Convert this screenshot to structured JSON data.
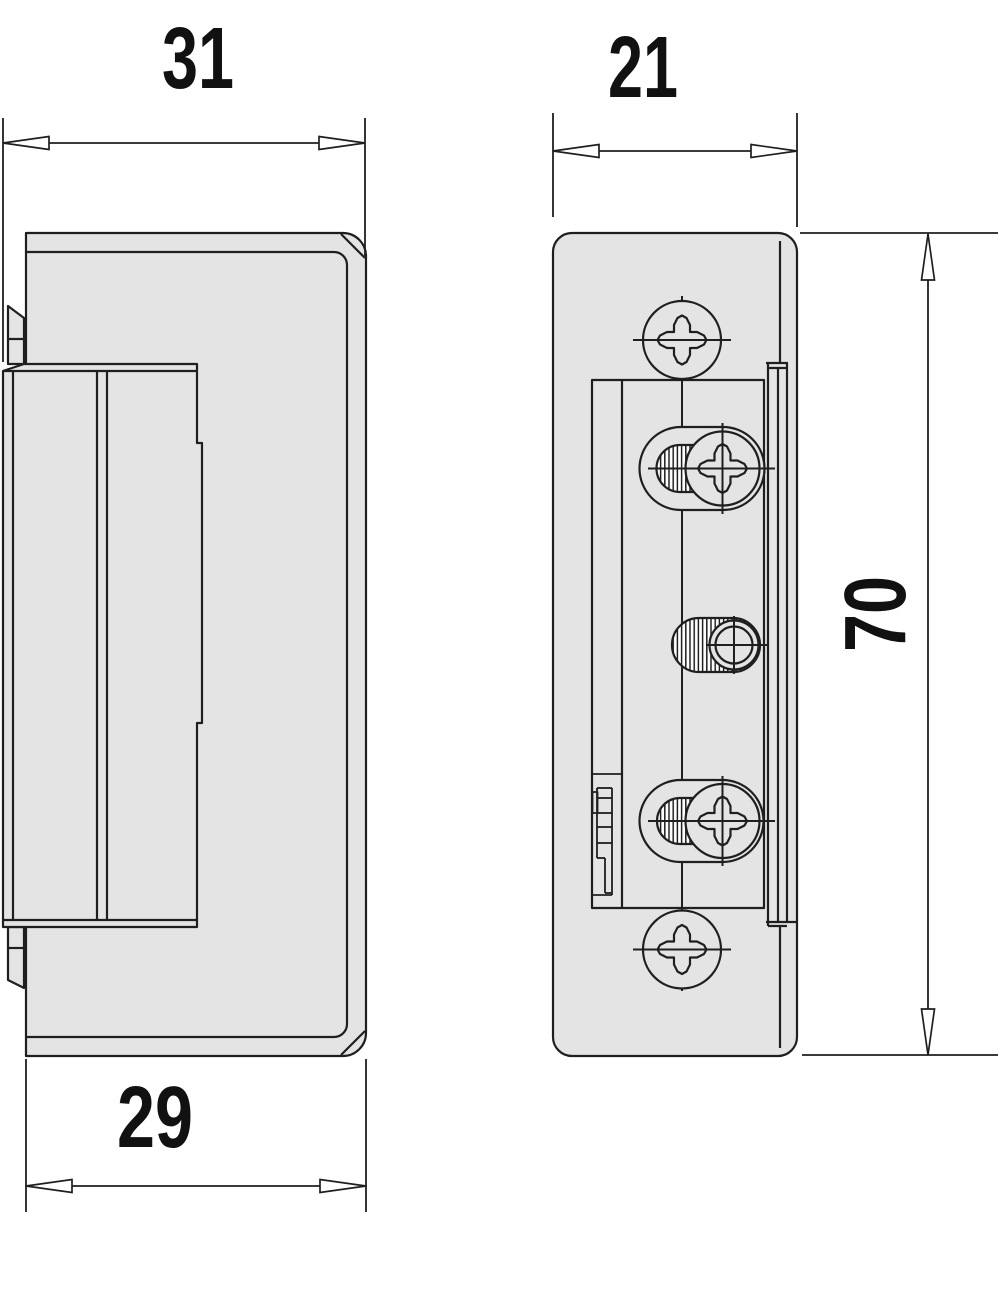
{
  "dimensions": {
    "side_overall_depth": "31",
    "front_width": "21",
    "side_body_depth": "29",
    "front_height": "70"
  },
  "colors": {
    "part_fill": "#e4e4e4",
    "line": "#1f1f1f",
    "background": "#ffffff",
    "dimension_text": "#111111"
  }
}
